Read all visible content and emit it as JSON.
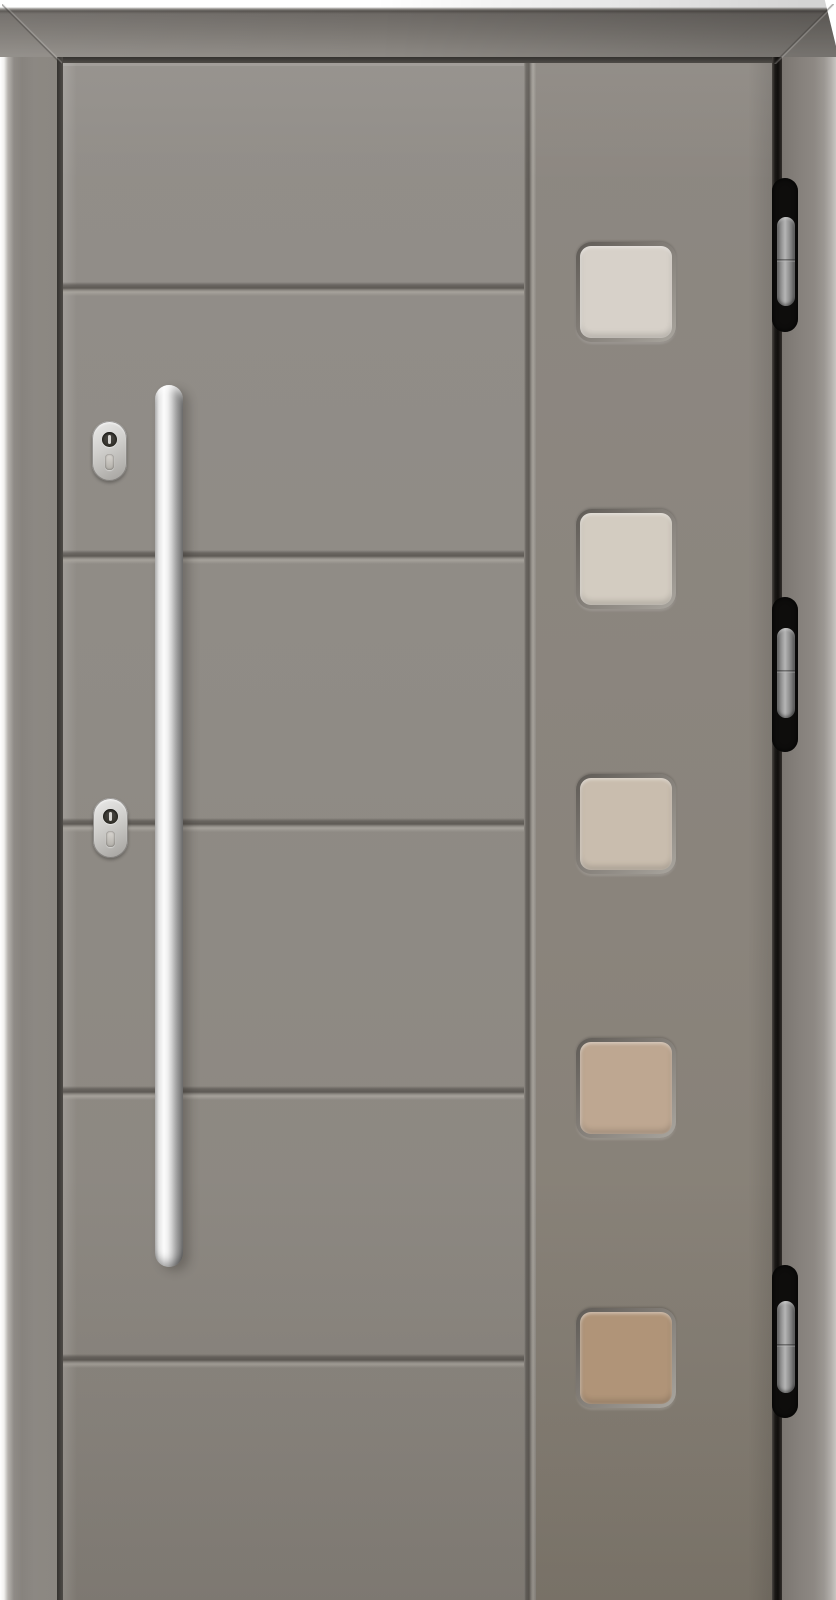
{
  "image": {
    "description": "Product photo of a modern grey entrance door: tall vertical stainless-steel pull handle on the left, two oval stainless lock cylinders, five horizontal panel grooves, a right-hand stile with five square glass panes, and three concealed hinges in the right rebate",
    "background_color": "#ffffff"
  },
  "frame": {
    "face_color": "#8b8781",
    "shadow_color": "#6e6a66",
    "highlight_color": "#f2f1ef",
    "seam_color": "#34322f"
  },
  "leaf": {
    "panel_color": "#8f8b85",
    "stile_color": "#8a847c",
    "groove_dark": "#5e5a55",
    "groove_light": "#aaa69f",
    "groove_count": 5
  },
  "glazing": {
    "pane_count": 5,
    "panes": [
      {
        "color": "#d7d1c9"
      },
      {
        "color": "#d3ccc1"
      },
      {
        "color": "#c9bdae"
      },
      {
        "color": "#bea791"
      },
      {
        "color": "#b09478"
      }
    ],
    "recess_dark": "#5f5b56",
    "recess_light": "#a9a59e"
  },
  "hardware": {
    "handle": {
      "finish_light": "#fcfcfc",
      "finish_dark": "#676767"
    },
    "locks": {
      "count": 2,
      "body_color": "#cfcecb",
      "keyhole_color": "#323029"
    },
    "hinges": {
      "count": 3,
      "recess_color": "#0e0d0c",
      "pin_color": "#9e9e9e"
    }
  }
}
